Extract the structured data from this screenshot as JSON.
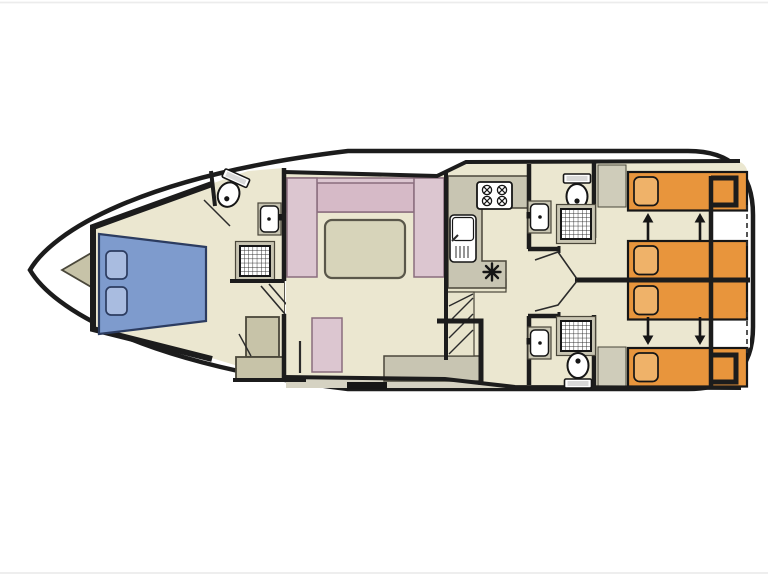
{
  "page": {
    "background": "#ffffff"
  },
  "colors": {
    "hull-outline": "#1c1c1c",
    "wall": "#1c1c1c",
    "deck": "#c7c3a8",
    "deck-strip": "#d5d2c2",
    "floor": "#ebe7d0",
    "counter": "#c8c5b2",
    "shelf": "#cfccba",
    "steps": "#e8e4cc",
    "bed-blue": "#7e9bcd",
    "pillow-blue": "#a9bce0",
    "sofa-pink": "#dcc6d0",
    "sofa-pink-dark": "#d6bac7",
    "table": "#d7d4ba",
    "bed-orange": "#e8953c",
    "pillow-orange": "#efb269",
    "fixture-white": "#ffffff",
    "page-edge": "#ececec"
  },
  "diagram": {
    "type": "houseboat-deck-plan",
    "orientation": "bow-left",
    "areas": [
      {
        "name": "bow-deck",
        "features": [
          "foredeck"
        ]
      },
      {
        "name": "bow-cabin",
        "features": [
          "double-bed",
          "pillow",
          "pillow",
          "wardrobe",
          "steps"
        ]
      },
      {
        "name": "bow-bathroom",
        "features": [
          "toilet",
          "washbasin",
          "shower"
        ]
      },
      {
        "name": "saloon",
        "features": [
          "u-shaped-sofa",
          "table",
          "seat",
          "sideboard"
        ]
      },
      {
        "name": "galley",
        "features": [
          "four-burner-hob",
          "sink-with-drainer",
          "counter",
          "heater"
        ]
      },
      {
        "name": "companionway",
        "features": [
          "landing",
          "steps"
        ]
      },
      {
        "name": "corridor",
        "features": [
          "door-swing",
          "door-swing"
        ]
      },
      {
        "name": "aft-bathroom-top",
        "features": [
          "toilet",
          "washbasin",
          "shower"
        ]
      },
      {
        "name": "aft-bathroom-bottom",
        "features": [
          "toilet",
          "washbasin",
          "shower"
        ]
      },
      {
        "name": "aft-cabin-top",
        "features": [
          "single-bed",
          "single-bed",
          "slide-arrow",
          "slide-arrow"
        ]
      },
      {
        "name": "aft-cabin-bottom",
        "features": [
          "single-bed",
          "single-bed",
          "slide-arrow",
          "slide-arrow"
        ]
      },
      {
        "name": "stern",
        "features": [
          "dashed-access",
          "dashed-access"
        ]
      }
    ]
  }
}
